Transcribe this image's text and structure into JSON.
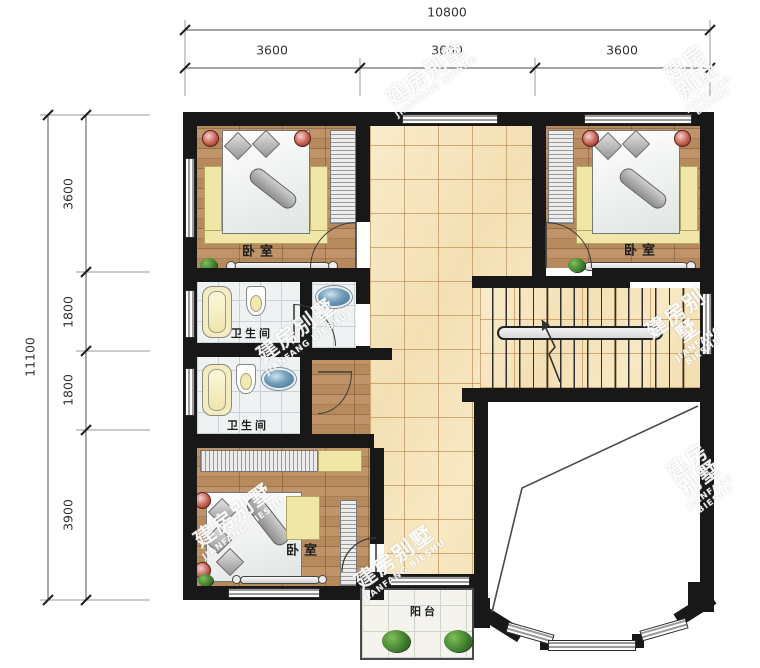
{
  "plan": {
    "dim_top": {
      "total": "10800",
      "segments": [
        "3600",
        "3600",
        "3600"
      ]
    },
    "dim_left": {
      "total": "11100",
      "segments": [
        "3600",
        "1800",
        "1800",
        "3900"
      ]
    },
    "rooms": {
      "bedroom_top_left": "卧室",
      "bedroom_top_right": "卧室",
      "bedroom_bottom": "卧室",
      "bathroom_upper": "卫生间",
      "bathroom_lower": "卫生间",
      "balcony": "阳台"
    },
    "watermark": {
      "cn": "建房别墅",
      "en": "JIANFANG BIESHU"
    }
  },
  "colors": {
    "wall": "#181818",
    "wood": "#b68a5c",
    "hall_tile": "#f6e5bf",
    "bath_tile": "#eef2f2",
    "basin": "#4e7da3",
    "plant": "#3f7d2e"
  }
}
